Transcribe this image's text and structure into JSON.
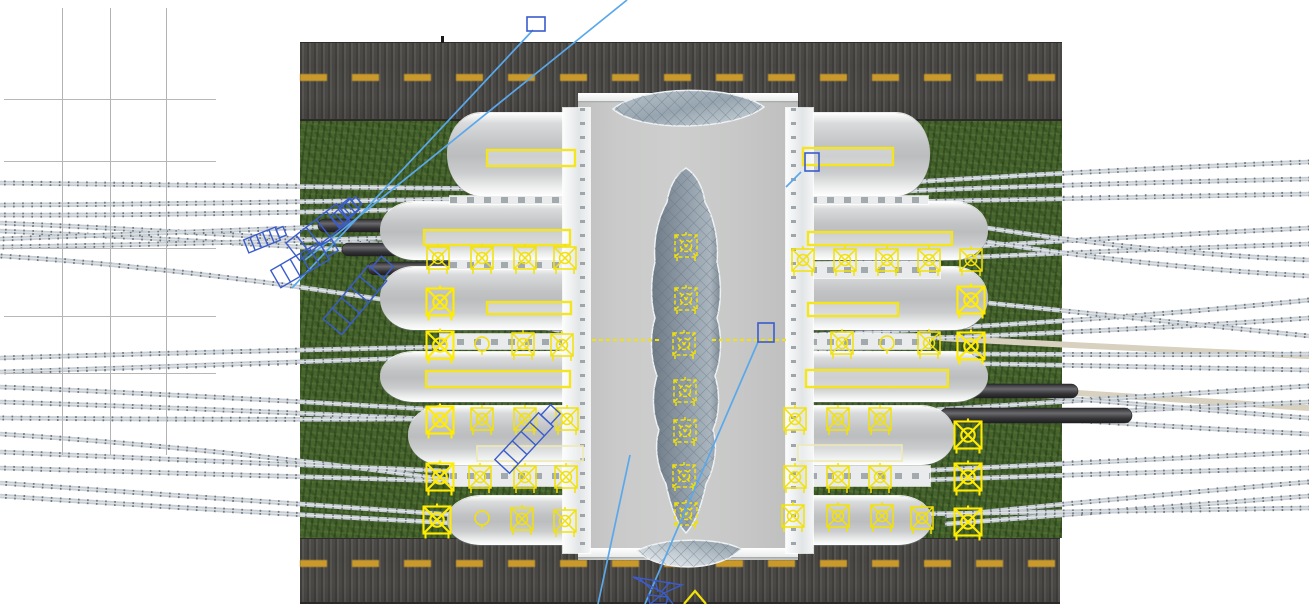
{
  "scene": {
    "kind": "3d-model-viewport-top-view",
    "subject": "railway-station-model",
    "background": "#ffffff",
    "colors": {
      "road_base": "#4b4a47",
      "road_dash": "#c9992b",
      "road_edge": "#2b2a28",
      "grass": "#47632e",
      "track_base": "#c6cdd3",
      "track_tie": "#6d757d",
      "track_light": "#dfe3e6",
      "track_tan": "#d8d1bf",
      "canopy": "#c3c4c5",
      "spine_roof": "#c9cac9",
      "colonnade": "#eff1f2",
      "glass_base": "#8d9aa6",
      "glass_line": "#5f6b76",
      "train_dark": "#353538",
      "train_light": "#6a6a6e",
      "annotation_yellow": "#f2e207",
      "annotation_yellow_bright": "#ffec00",
      "annotation_yellow_pale": "#efe9b4",
      "selection_blue": "#3a5ccc",
      "leader_blue": "#5aa8ec"
    }
  },
  "ground": {
    "roads": [
      {
        "name": "road-top",
        "x": 300,
        "y": 42,
        "w": 762,
        "h": 79,
        "dash_y": 74
      },
      {
        "name": "road-bottom",
        "x": 300,
        "y": 538,
        "w": 760,
        "h": 66,
        "dash_y": 560
      }
    ],
    "road_tick": {
      "x": 441,
      "y": 36,
      "w": 3,
      "h": 7
    },
    "grass": {
      "x": 300,
      "y": 121,
      "w": 762,
      "h": 417
    }
  },
  "tracks": {
    "left_upper": [
      [
        588,
        190,
        300,
        186,
        0,
        183
      ],
      [
        588,
        196,
        240,
        204,
        0,
        205
      ],
      [
        588,
        204,
        240,
        216,
        0,
        215
      ],
      [
        588,
        258,
        250,
        234,
        0,
        223
      ],
      [
        588,
        266,
        250,
        242,
        0,
        231
      ],
      [
        450,
        222,
        200,
        232,
        0,
        239
      ],
      [
        450,
        236,
        200,
        244,
        0,
        247
      ],
      [
        588,
        336,
        260,
        272,
        0,
        256
      ]
    ],
    "left_lower": [
      [
        588,
        344,
        270,
        350,
        0,
        358
      ],
      [
        588,
        352,
        270,
        364,
        0,
        372
      ],
      [
        588,
        419,
        260,
        398,
        0,
        387
      ],
      [
        588,
        427,
        260,
        410,
        0,
        402
      ],
      [
        450,
        419,
        220,
        420,
        0,
        418
      ],
      [
        450,
        480,
        220,
        448,
        0,
        434
      ],
      [
        588,
        477,
        270,
        464,
        0,
        452
      ],
      [
        588,
        485,
        270,
        476,
        0,
        468
      ],
      [
        470,
        516,
        240,
        500,
        0,
        483
      ],
      [
        470,
        524,
        240,
        512,
        0,
        496
      ]
    ],
    "right_upper": [
      [
        790,
        190,
        1050,
        172,
        1309,
        162
      ],
      [
        790,
        196,
        1050,
        184,
        1309,
        179
      ],
      [
        790,
        204,
        1060,
        198,
        1309,
        194
      ],
      [
        790,
        258,
        1060,
        240,
        1309,
        228
      ],
      [
        790,
        266,
        1060,
        252,
        1309,
        244
      ],
      [
        950,
        222,
        1130,
        252,
        1309,
        260
      ],
      [
        950,
        236,
        1130,
        266,
        1309,
        276
      ],
      [
        790,
        336,
        1100,
        322,
        1309,
        300
      ],
      [
        790,
        344,
        1150,
        330,
        1309,
        318
      ],
      [
        960,
        300,
        1150,
        320,
        1309,
        336
      ]
    ],
    "right_lower": [
      [
        790,
        352,
        1100,
        356,
        1309,
        354
      ],
      [
        790,
        360,
        1100,
        366,
        1309,
        370
      ],
      [
        790,
        419,
        1080,
        400,
        1309,
        386
      ],
      [
        790,
        427,
        1080,
        412,
        1309,
        402
      ],
      [
        1000,
        392,
        1150,
        406,
        1309,
        418
      ],
      [
        1000,
        415,
        1150,
        426,
        1309,
        434
      ],
      [
        790,
        477,
        1080,
        462,
        1309,
        452
      ],
      [
        790,
        485,
        1080,
        474,
        1309,
        468
      ],
      [
        945,
        516,
        1120,
        498,
        1309,
        482
      ],
      [
        945,
        524,
        1120,
        510,
        1309,
        496
      ],
      [
        790,
        516,
        1080,
        512,
        1309,
        508
      ]
    ],
    "tan_strips": [
      [
        940,
        338,
        1120,
        348,
        1309,
        356
      ],
      [
        1000,
        388,
        1150,
        398,
        1309,
        408
      ]
    ]
  },
  "trains": [
    {
      "x": 318,
      "y": 219,
      "w": 267,
      "h": 13
    },
    {
      "x": 342,
      "y": 243,
      "w": 243,
      "h": 13
    },
    {
      "x": 368,
      "y": 262,
      "w": 217,
      "h": 13
    },
    {
      "x": 940,
      "y": 384,
      "w": 138,
      "h": 14
    },
    {
      "x": 940,
      "y": 408,
      "w": 192,
      "h": 15
    }
  ],
  "station": {
    "spine": {
      "x": 578,
      "y": 97,
      "w": 220,
      "h": 463
    },
    "trims": [
      {
        "x": 578,
        "y": 93,
        "w": 220,
        "h": 8
      },
      {
        "x": 578,
        "y": 548,
        "w": 220,
        "h": 9
      }
    ],
    "colonnades": [
      {
        "x": 563,
        "y": 108,
        "w": 27,
        "h": 445
      },
      {
        "x": 786,
        "y": 108,
        "w": 27,
        "h": 445
      }
    ],
    "seams_v": [
      640,
      688,
      744
    ],
    "seams_h": [
      196,
      258,
      345,
      413,
      470
    ],
    "wings_left": [
      {
        "x": 447,
        "y": 113,
        "w": 134,
        "h": 83
      },
      {
        "x": 380,
        "y": 202,
        "w": 201,
        "h": 58
      },
      {
        "x": 380,
        "y": 267,
        "w": 201,
        "h": 63
      },
      {
        "x": 380,
        "y": 352,
        "w": 201,
        "h": 50
      },
      {
        "x": 408,
        "y": 406,
        "w": 173,
        "h": 59
      },
      {
        "x": 447,
        "y": 496,
        "w": 134,
        "h": 49
      }
    ],
    "wings_right": [
      {
        "x": 798,
        "y": 113,
        "w": 132,
        "h": 83
      },
      {
        "x": 798,
        "y": 202,
        "w": 190,
        "h": 58
      },
      {
        "x": 798,
        "y": 267,
        "w": 190,
        "h": 63
      },
      {
        "x": 798,
        "y": 352,
        "w": 190,
        "h": 50
      },
      {
        "x": 798,
        "y": 406,
        "w": 157,
        "h": 59
      },
      {
        "x": 798,
        "y": 496,
        "w": 134,
        "h": 49
      }
    ],
    "platform_strips": [
      {
        "x": 450,
        "y": 196,
        "w": 133,
        "h": 8
      },
      {
        "x": 450,
        "y": 260,
        "w": 133,
        "h": 9
      },
      {
        "x": 440,
        "y": 334,
        "w": 143,
        "h": 15
      },
      {
        "x": 450,
        "y": 466,
        "w": 133,
        "h": 20
      },
      {
        "x": 793,
        "y": 196,
        "w": 135,
        "h": 8
      },
      {
        "x": 793,
        "y": 262,
        "w": 147,
        "h": 16
      },
      {
        "x": 793,
        "y": 334,
        "w": 137,
        "h": 15
      },
      {
        "x": 793,
        "y": 466,
        "w": 137,
        "h": 20
      }
    ],
    "lens_top": "M613,109 C642,85 733,84 764,107 C733,131 641,133 613,109 Z",
    "lens_bottom": "M637,551 C661,537 719,537 741,549 C719,572 660,573 637,551 Z",
    "atrium": "M686,168 C697,175 703,188 705,202 C714,218 719,240 717,262 C721,278 722,300 717,318 C722,334 722,358 715,376 C720,392 720,414 713,430 C718,446 715,468 706,484 C702,504 696,522 686,533 C676,522 670,504 666,484 C657,468 654,446 659,430 C652,414 652,392 657,376 C650,358 650,334 655,318 C650,300 651,278 655,262 C653,240 658,218 667,202 C669,188 675,175 686,168 Z"
  },
  "annotations_yellow": {
    "skylights": [
      {
        "x": 487,
        "y": 150,
        "w": 88,
        "h": 16,
        "tone": "bright"
      },
      {
        "x": 803,
        "y": 148,
        "w": 90,
        "h": 17,
        "tone": "bright"
      },
      {
        "x": 424,
        "y": 230,
        "w": 146,
        "h": 15,
        "tone": "bright"
      },
      {
        "x": 808,
        "y": 232,
        "w": 144,
        "h": 13,
        "tone": "bright"
      },
      {
        "x": 487,
        "y": 302,
        "w": 84,
        "h": 12,
        "tone": "bright"
      },
      {
        "x": 808,
        "y": 303,
        "w": 90,
        "h": 13,
        "tone": "bright"
      },
      {
        "x": 426,
        "y": 371,
        "w": 144,
        "h": 16,
        "tone": "bright"
      },
      {
        "x": 806,
        "y": 370,
        "w": 142,
        "h": 17,
        "tone": "bright"
      },
      {
        "x": 477,
        "y": 446,
        "w": 106,
        "h": 15,
        "tone": "pale"
      },
      {
        "x": 798,
        "y": 445,
        "w": 104,
        "h": 16,
        "tone": "pale"
      }
    ],
    "light_markers": [
      {
        "x": 438,
        "y": 258
      },
      {
        "x": 482,
        "y": 258
      },
      {
        "x": 525,
        "y": 258
      },
      {
        "x": 565,
        "y": 258
      },
      {
        "x": 803,
        "y": 260
      },
      {
        "x": 845,
        "y": 260
      },
      {
        "x": 887,
        "y": 260
      },
      {
        "x": 929,
        "y": 260
      },
      {
        "x": 971,
        "y": 260
      },
      {
        "x": 440,
        "y": 302,
        "bright": true
      },
      {
        "x": 971,
        "y": 300,
        "bright": true
      },
      {
        "x": 440,
        "y": 345,
        "bright": true
      },
      {
        "x": 482,
        "y": 344,
        "type": "circle"
      },
      {
        "x": 523,
        "y": 344
      },
      {
        "x": 562,
        "y": 345
      },
      {
        "x": 842,
        "y": 343
      },
      {
        "x": 887,
        "y": 343,
        "type": "circle"
      },
      {
        "x": 929,
        "y": 343
      },
      {
        "x": 971,
        "y": 346,
        "bright": true
      },
      {
        "x": 440,
        "y": 420,
        "bright": true
      },
      {
        "x": 482,
        "y": 419
      },
      {
        "x": 525,
        "y": 419
      },
      {
        "x": 567,
        "y": 419
      },
      {
        "x": 795,
        "y": 419
      },
      {
        "x": 838,
        "y": 419
      },
      {
        "x": 880,
        "y": 419
      },
      {
        "x": 968,
        "y": 435,
        "bright": true
      },
      {
        "x": 440,
        "y": 477,
        "bright": true
      },
      {
        "x": 480,
        "y": 477
      },
      {
        "x": 525,
        "y": 477
      },
      {
        "x": 566,
        "y": 477
      },
      {
        "x": 795,
        "y": 477
      },
      {
        "x": 838,
        "y": 477
      },
      {
        "x": 880,
        "y": 477
      },
      {
        "x": 968,
        "y": 477,
        "bright": true
      },
      {
        "x": 437,
        "y": 520,
        "bright": true
      },
      {
        "x": 482,
        "y": 518,
        "type": "circle"
      },
      {
        "x": 522,
        "y": 519
      },
      {
        "x": 565,
        "y": 521
      },
      {
        "x": 793,
        "y": 516
      },
      {
        "x": 838,
        "y": 516
      },
      {
        "x": 882,
        "y": 516
      },
      {
        "x": 922,
        "y": 518
      },
      {
        "x": 968,
        "y": 522,
        "bright": true
      },
      {
        "x": 686,
        "y": 246,
        "dashed": true
      },
      {
        "x": 686,
        "y": 299,
        "dashed": true
      },
      {
        "x": 684,
        "y": 344,
        "dashed": true
      },
      {
        "x": 685,
        "y": 391,
        "dashed": true
      },
      {
        "x": 685,
        "y": 431,
        "dashed": true
      },
      {
        "x": 684,
        "y": 476,
        "dashed": true
      },
      {
        "x": 686,
        "y": 514,
        "dashed": true
      }
    ],
    "dashed_lines": [
      [
        592,
        340,
        660,
        340
      ],
      [
        712,
        340,
        786,
        340
      ]
    ],
    "chevron": "M684,604 L695,591 L706,604"
  },
  "annotations_blue": {
    "selection_squares": [
      {
        "x": 527,
        "y": 17,
        "w": 18,
        "h": 14
      },
      {
        "x": 805,
        "y": 153,
        "w": 14,
        "h": 18
      },
      {
        "x": 758,
        "y": 323,
        "w": 16,
        "h": 19
      }
    ],
    "leader_lines": [
      [
        627,
        0,
        305,
        260
      ],
      [
        533,
        30,
        292,
        288
      ],
      [
        758,
        342,
        645,
        604
      ],
      [
        630,
        455,
        598,
        604
      ],
      [
        786,
        187,
        801,
        172
      ]
    ],
    "wireframe_ladders": [
      {
        "cx": 318,
        "cy": 232,
        "w": 64,
        "h": 22,
        "angle": -38
      },
      {
        "cx": 300,
        "cy": 265,
        "w": 56,
        "h": 20,
        "angle": -30
      },
      {
        "cx": 355,
        "cy": 300,
        "w": 70,
        "h": 24,
        "angle": -50
      },
      {
        "cx": 262,
        "cy": 240,
        "w": 34,
        "h": 14,
        "angle": -22
      },
      {
        "cx": 345,
        "cy": 213,
        "w": 26,
        "h": 14,
        "angle": -42
      },
      {
        "cx": 524,
        "cy": 443,
        "w": 64,
        "h": 20,
        "angle": -47
      }
    ],
    "funnel": [
      "M633,577 L682,585 L664,593 Z",
      "M664,593 L673,604",
      "M664,593 L650,604",
      "M640,579 L652,590",
      "M655,580 L658,592",
      "M670,582 L662,591",
      "M648,595 L668,597 L666,604 L650,604 Z"
    ]
  }
}
